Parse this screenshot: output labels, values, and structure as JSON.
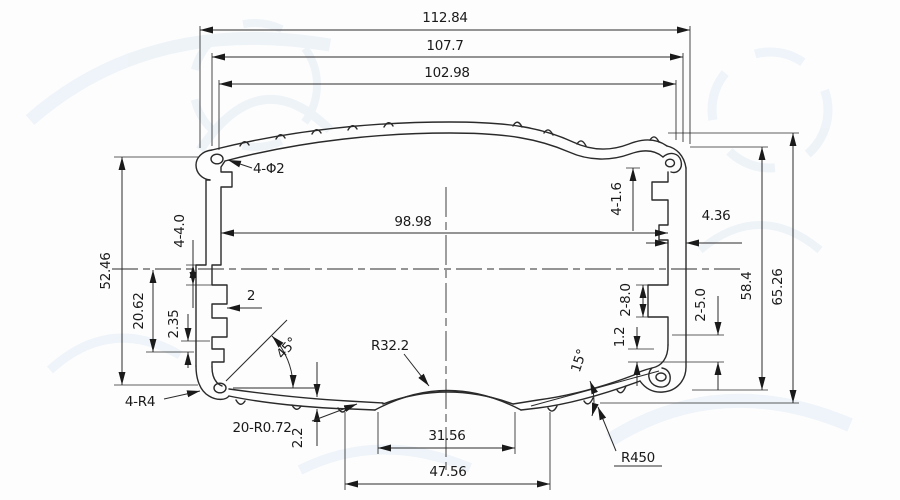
{
  "drawing": {
    "dims": {
      "w_overall": "112.84",
      "w_107": "107.7",
      "w_102": "102.98",
      "w_inner": "98.98",
      "w_436": "4.36",
      "w_2": "2",
      "w_3156": "31.56",
      "w_4756": "47.56",
      "h_5246": "52.46",
      "h_2062": "20.62",
      "h_235": "2.35",
      "h_584": "58.4",
      "h_6526": "65.26",
      "t_22": "2.2",
      "t_12": "1.2",
      "f_holes": "4-Φ2",
      "f_440": "4-4.0",
      "f_416": "4-1.6",
      "f_280": "2-8.0",
      "f_250": "2-5.0",
      "r_322": "R32.2",
      "r_450": "R450",
      "r_4r4": "4-R4",
      "r_r072": "20-R0.72",
      "a_45": "45°",
      "a_15": "15°"
    },
    "colors": {
      "line": "#2a2a2a",
      "paper": "#fdfdfd",
      "watermark": "#e2ecf5"
    }
  }
}
